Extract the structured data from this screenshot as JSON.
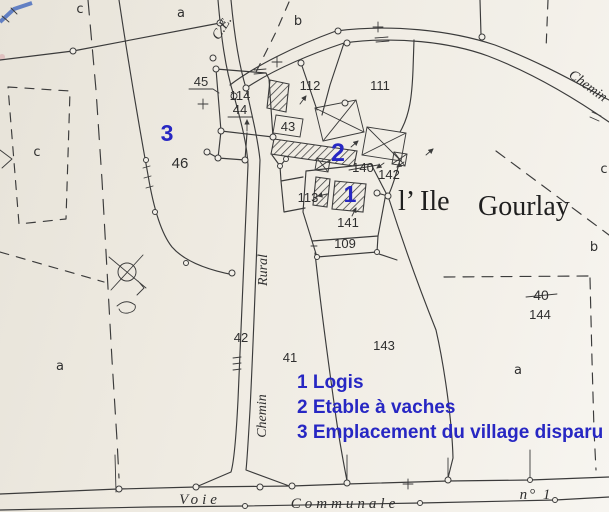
{
  "colors": {
    "paper": "#efebe2",
    "ink": "#3b3b3b",
    "blue": "#2727c3"
  },
  "place": {
    "ile": "l’ Ile",
    "gourlay": "Gourlay"
  },
  "roads": {
    "ce": "C.E.",
    "chemin_top": "Chemin",
    "rural": "Rural",
    "chemin_vertical": "Chemin",
    "voie": "Voie",
    "communale": "Communale",
    "numero": "n° 1"
  },
  "sections": {
    "c_top": "c",
    "a_top": "a",
    "b_top": "b",
    "c_left": "c",
    "c_right": "c",
    "b_right": "b",
    "a_bottom_left": "a",
    "a_bottom_right": "a"
  },
  "parcels": {
    "p45": "45",
    "p114": "114",
    "p44": "44",
    "p43": "43",
    "p112": "112",
    "p111": "111",
    "p46": "46",
    "p113": "113",
    "p141": "141",
    "p109": "109",
    "p140_old": "140",
    "p142": "142",
    "p40_old": "40",
    "p144": "144",
    "p42": "42",
    "p41": "41",
    "p143": "143"
  },
  "blue_marks": {
    "m1": "1",
    "m2": "2",
    "m3": "3"
  },
  "legend": {
    "line1": "1 Logis",
    "line2": "2 Etable à vaches",
    "line3": "3 Emplacement du village disparu"
  }
}
